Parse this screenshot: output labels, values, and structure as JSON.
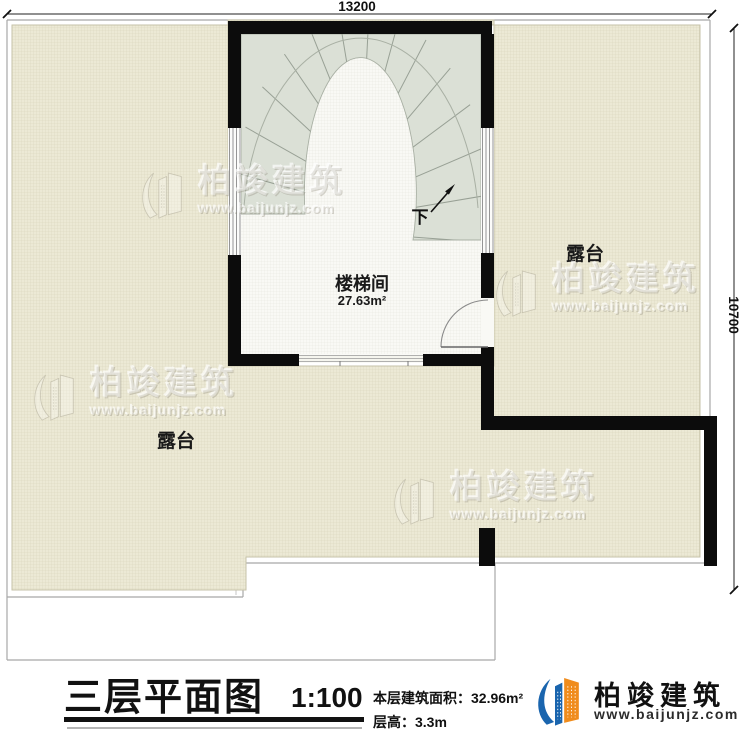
{
  "dimensions": {
    "width_mm": "13200",
    "height_mm": "10700"
  },
  "plan": {
    "stairwell_name": "楼梯间",
    "stairwell_area": "27.63m²",
    "terrace_right": "露台",
    "terrace_left": "露台",
    "stair_down": "下"
  },
  "watermark": {
    "brand": "柏竣建筑",
    "url": "www.baijunjz.com"
  },
  "title_block": {
    "title": "三层平面图",
    "scale": "1:100",
    "area_label": "本层建筑面积：",
    "area_value": "32.96m²",
    "floor_height_label": "层高：",
    "floor_height_value": "3.3m"
  },
  "logo": {
    "brand": "柏竣建筑",
    "url": "www.baijunjz.com"
  },
  "colors": {
    "terrace_fill": "#ece9d5",
    "terrace_grid": "#d8d4bb",
    "floor_fill": "#f9f9f5",
    "stair_fill": "#dbe0d6",
    "wall": "#0c0c0c",
    "logo_blue": "#1a65ae",
    "logo_orange": "#f08c1c"
  }
}
